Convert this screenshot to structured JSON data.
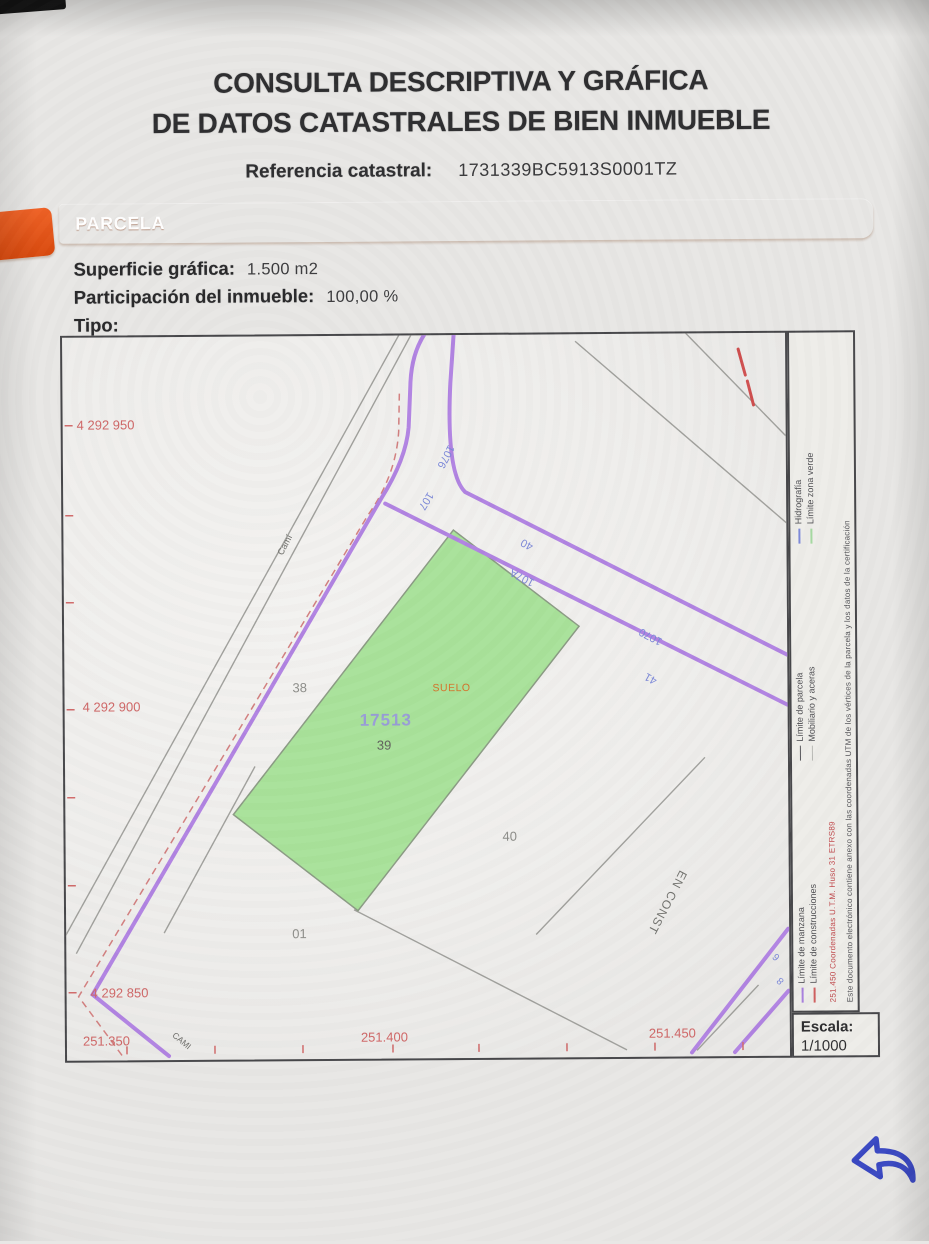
{
  "document": {
    "title_line1": "CONSULTA DESCRIPTIVA Y GRÁFICA",
    "title_line2": "DE DATOS CATASTRALES DE BIEN INMUEBLE",
    "reference_label": "Referencia catastral:",
    "reference_value": "1731339BC5913S0001TZ",
    "section_header": "PARCELA",
    "fields": [
      {
        "label": "Superficie gráfica:",
        "value": "1.500 m2"
      },
      {
        "label": "Participación del inmueble:",
        "value": "100,00 %"
      },
      {
        "label": "Tipo:",
        "value": ""
      }
    ]
  },
  "map": {
    "y_axis_labels": [
      "4 292 950",
      "4 292 900",
      "4 292 850"
    ],
    "x_axis_labels": [
      "251.350",
      "251.400",
      "251.450"
    ],
    "subject_parcel": {
      "number": "17513",
      "land_use": "SUELO",
      "sub_number": "39"
    },
    "neighbor_parcels": [
      "38",
      "40",
      "01"
    ],
    "construction_label": "EN CONST",
    "street_label_upper": "Camí",
    "street_label_lower": "CAMI",
    "house_numbers": [
      "1076",
      "107",
      "40",
      "107A",
      "1070",
      "41",
      "6",
      "8"
    ],
    "scale_label": "Escala:",
    "scale_value": "1/1000",
    "legend": {
      "groups": [
        {
          "entries": [
            {
              "label": "Límite de manzana",
              "color": "#a87fdd"
            },
            {
              "label": "Límite de construcciones",
              "color": "#d06060"
            }
          ]
        },
        {
          "entries": [
            {
              "label": "Límite de parcela",
              "color": "#5a5a5e"
            },
            {
              "label": "Mobiliario y aceras",
              "color": "#b9b9b5"
            }
          ]
        },
        {
          "entries": [
            {
              "label": "Hidrografía",
              "color": "#7c88d8"
            },
            {
              "label": "Límite zona verde",
              "color": "#a4d8a0"
            }
          ]
        }
      ],
      "coords_note": "251.450 Coordenadas U.T.M. Huso 31 ETRS89",
      "cert_note": "Este documento electrónico contiene anexo con las coordenadas UTM de los vértices de la parcela y los datos de la certificación"
    }
  },
  "nav": {
    "back_icon": "reply-arrow"
  },
  "colors": {
    "accent_orange": "#e65417",
    "parcel_fill_green": "#a9e29a",
    "road_line_purple": "#b183e2",
    "axis_label_red": "#cf6868",
    "house_number_blue": "#7c88d8",
    "back_arrow_blue": "#3a48c2"
  }
}
